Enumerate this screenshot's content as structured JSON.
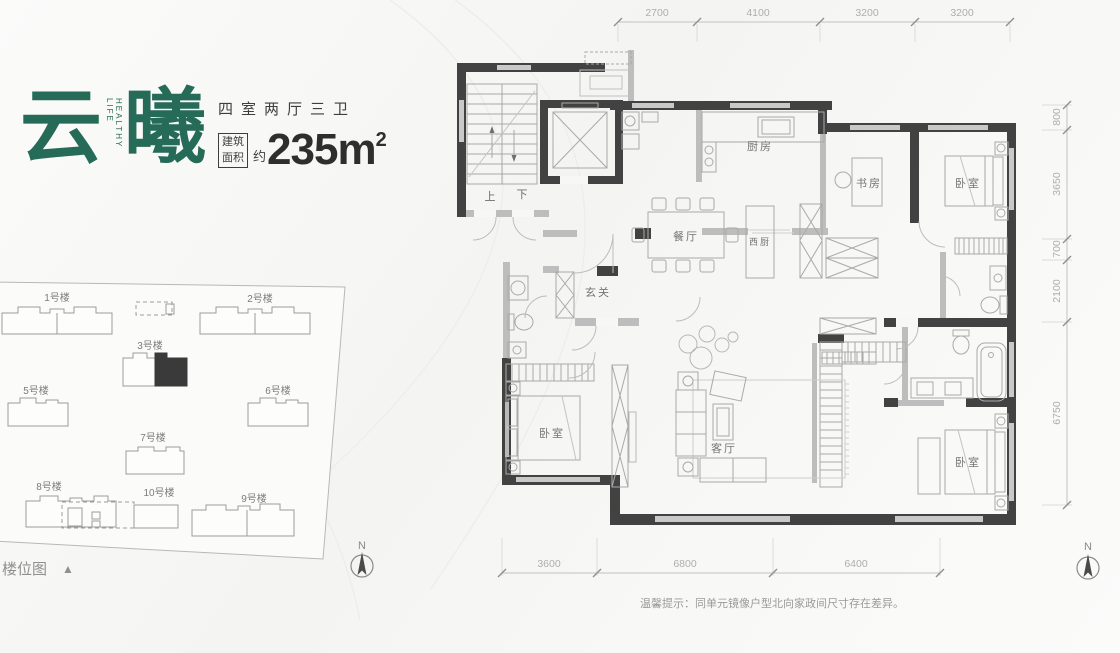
{
  "header": {
    "brand_char_1": "云",
    "brand_char_2": "曦",
    "brand_sub": "HEALTHY LIFE",
    "layout_type": "四室两厅三卫",
    "area_box_top": "建筑",
    "area_box_bottom": "面积",
    "area_prefix": "约",
    "area_value": "235m",
    "area_sup": "2"
  },
  "site_plan": {
    "title": "楼位图",
    "title_marker": "▲",
    "north_label": "N",
    "buildings": [
      {
        "label": "1号楼"
      },
      {
        "label": "2号楼"
      },
      {
        "label": "3号楼"
      },
      {
        "label": "5号楼"
      },
      {
        "label": "6号楼"
      },
      {
        "label": "7号楼"
      },
      {
        "label": "8号楼"
      },
      {
        "label": "10号楼"
      },
      {
        "label": "9号楼"
      }
    ]
  },
  "floor_plan": {
    "rooms": {
      "kitchen": "厨房",
      "study": "书房",
      "bedroom_ne": "卧室",
      "dining": "餐厅",
      "west_kitchen": "西厨",
      "foyer": "玄关",
      "bedroom_sw": "卧室",
      "living": "客厅",
      "bedroom_se": "卧室"
    },
    "stairs": {
      "up": "上",
      "down": "下"
    },
    "dims_top": [
      "2700",
      "4100",
      "3200",
      "3200"
    ],
    "dims_right": [
      "800",
      "3650",
      "700",
      "2100",
      "6750"
    ],
    "dims_bottom": [
      "3600",
      "6800",
      "6400"
    ],
    "north_label": "N",
    "note": "温馨提示：同单元镜像户型北向家政间尺寸存在差异。"
  },
  "colors": {
    "brand_green": "#266a58",
    "wall_dark": "#424242",
    "wall_light": "#bdbdbd",
    "dim_gray": "#aeaeae",
    "highlight_building": "#3a3a3a"
  }
}
